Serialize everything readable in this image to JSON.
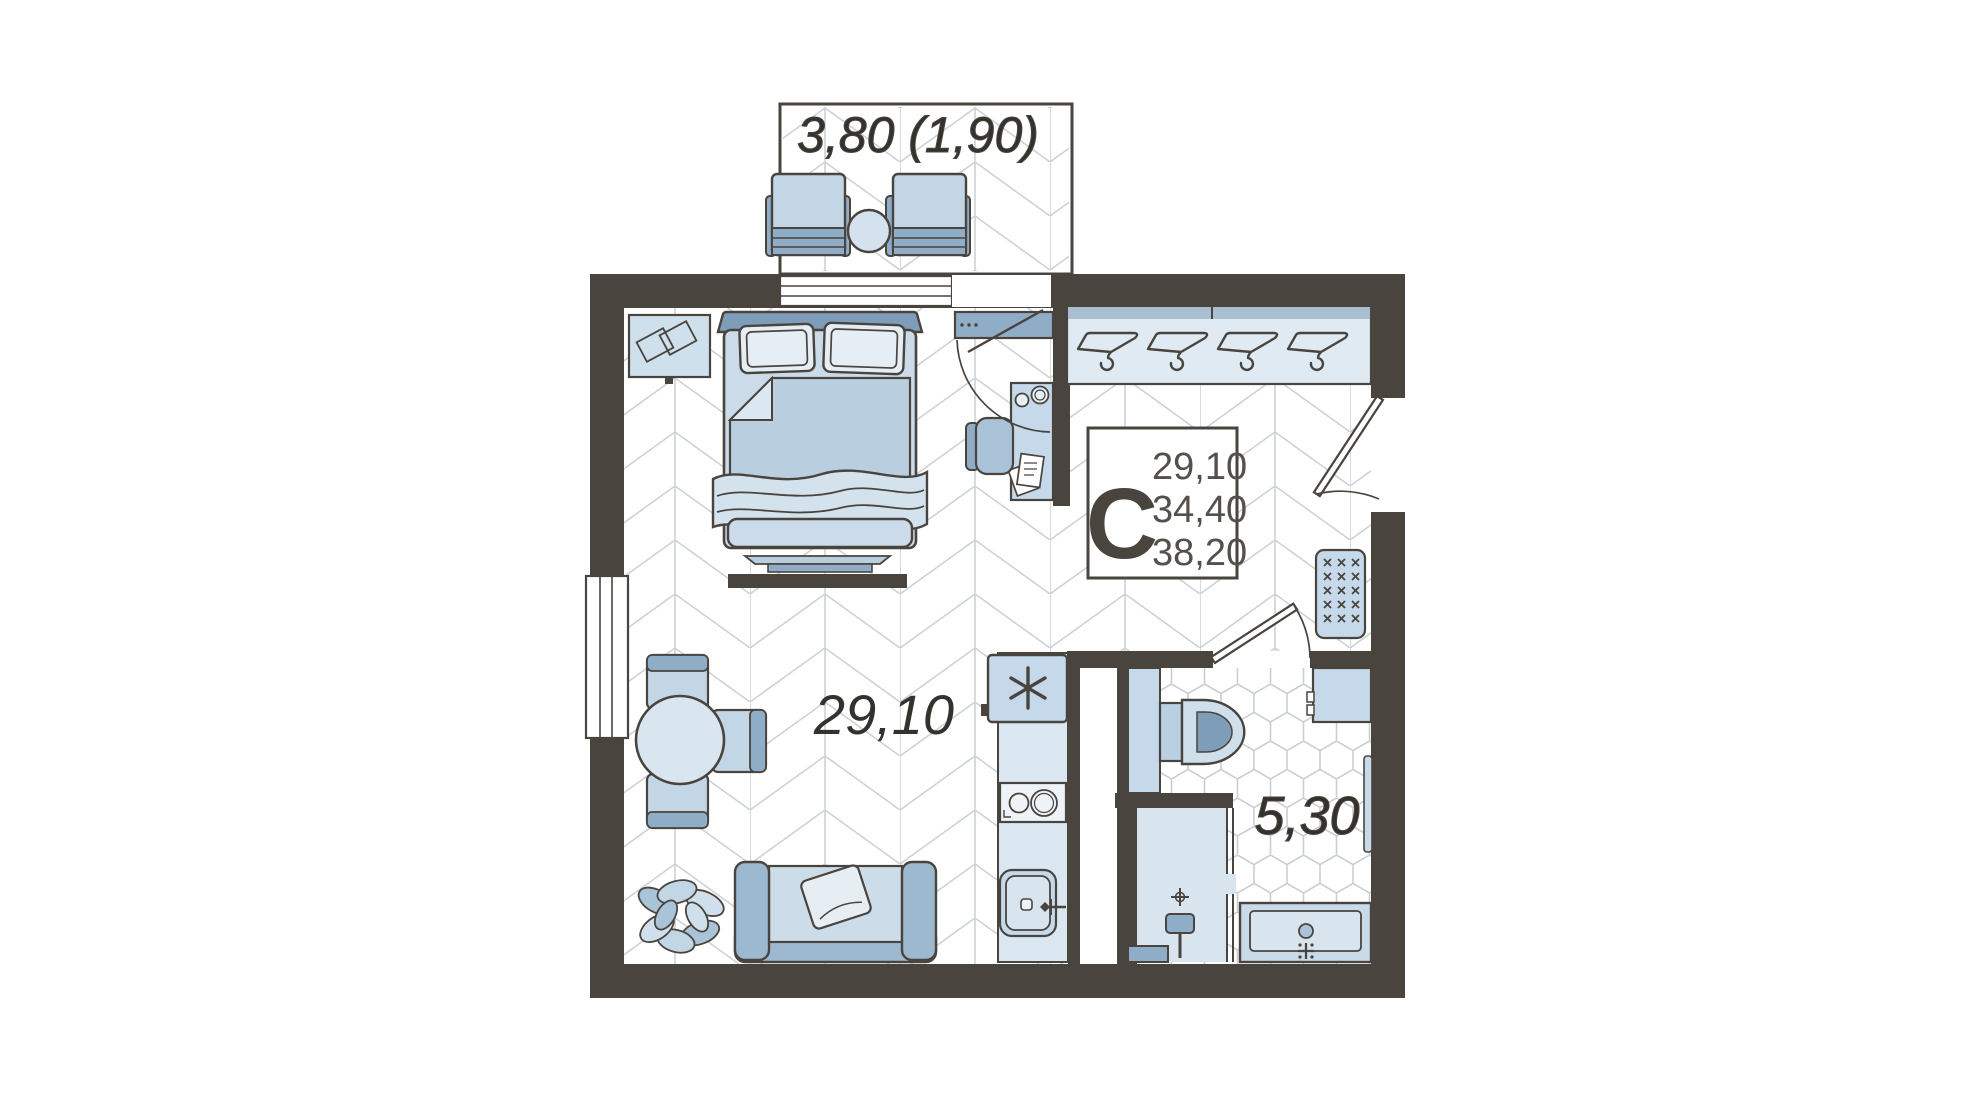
{
  "floor_plan": {
    "title": "studio apartment floor plan",
    "balcony": {
      "area_label": "3,80 (1,90)"
    },
    "studio_room": {
      "area_label": "29,10"
    },
    "bathroom": {
      "area_label": "5,30"
    },
    "info_box": {
      "type_letter": "С",
      "living_area": "29,10",
      "apartment_area": "34,40",
      "total_area": "38,20"
    },
    "colors": {
      "wall": "#4a443e",
      "outline": "#4a443e",
      "furniture_light": "#c5d8e8",
      "furniture_pale": "#dfeaf2",
      "furniture_medium": "#a9c2d8",
      "furniture_dark": "#8fadc6",
      "headboard_blue": "#7e9db9",
      "parquet_line": "#cdd2d6",
      "tile_line": "#c9ced3",
      "label_text": "#35322e",
      "info_number_text": "#55504b",
      "background": "#ffffff"
    },
    "icons": {
      "wardrobe": "hanger-icon",
      "fridge": "snowflake-asterisk-icon",
      "shower": "drain-crosshair-icon",
      "sinks": "faucet-cross-icon",
      "cabinet": "x-marks-icon"
    }
  }
}
